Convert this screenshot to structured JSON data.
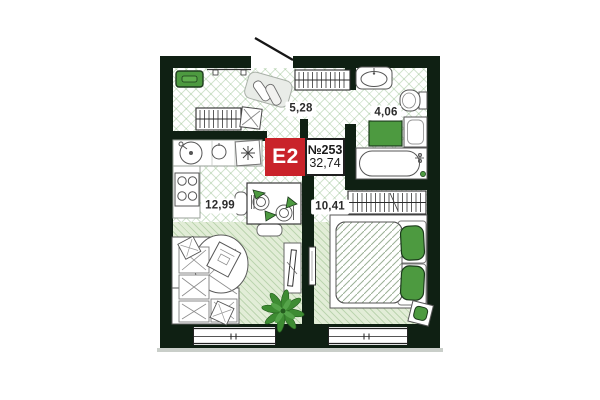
{
  "unit": {
    "type_label": "E2",
    "number": "№253",
    "total_area": "32,74"
  },
  "rooms": {
    "hallway": {
      "area": "5,28"
    },
    "bathroom": {
      "area": "4,06"
    },
    "kitchen_living": {
      "area": "12,99"
    },
    "bedroom": {
      "area": "10,41"
    }
  },
  "furniture_visible": [
    "entry-bench",
    "wall-shelf",
    "shoe-cabinet",
    "hanger-wardrobe",
    "pouf",
    "kitchen-sink",
    "cooktop-asterisk",
    "stove",
    "dining-table",
    "chairs",
    "corner-sofa",
    "tv-stand",
    "plant",
    "bathroom-sink",
    "toilet",
    "bath-mat",
    "washing-machine",
    "bathtub",
    "bedroom-wardrobe",
    "double-bed",
    "green-pillows",
    "stool",
    "wall-tv",
    "windows",
    "entrance-door"
  ],
  "colors": {
    "wall": "#0f2013",
    "accent_green": "#4d9a40",
    "badge_red": "#c9232a",
    "floor_green": "#e2edd7",
    "parapet_grey": "#c9cec9"
  }
}
